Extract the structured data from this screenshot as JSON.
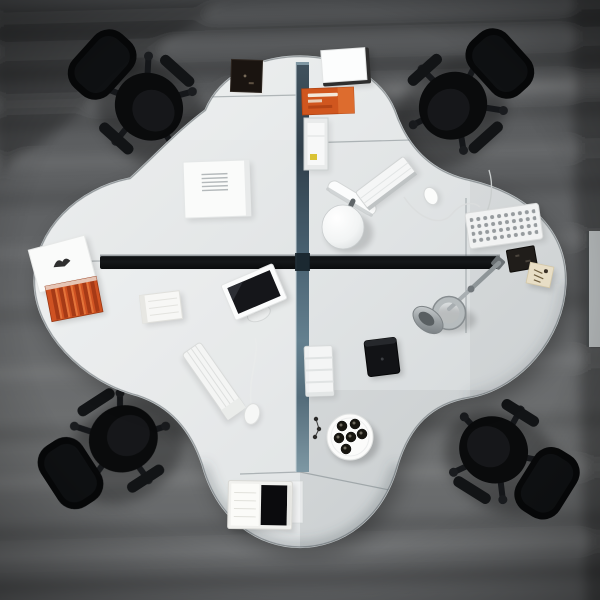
{
  "meta": {
    "description": "Overhead photograph of a four-person clover-shaped white office workstation with a blue-gray cross partition, four black task chairs and desk accessories, on a streaked gray floor."
  },
  "colors": {
    "floorBase": "#5b5d5f",
    "chairBlack": "#0a0b0c",
    "paperWhite": "#fafbfa",
    "deskTop": "#e2e5e6",
    "deskEdge": "#c5cacc",
    "partitionBlue": "#4a6272",
    "railDark": "#141719",
    "accentOrange": "#d0561e",
    "accentRed": "#cf5222",
    "screenDark": "#15161a",
    "metalGray": "#9aa0a3",
    "noteTan": "#e8dec6"
  },
  "labels": {
    "scene": "Top-down office workstation photograph",
    "floor": "Gray streaked office floor",
    "desk": "Clover-shaped four-seat desk island",
    "partition": "Vertical blue-gray privacy partition",
    "rail": "Horizontal black desk rail",
    "edgeFurniture": "Light furniture strip at right image edge",
    "chairNW": "Black office chair, top left",
    "chairNE": "Black office chair, top right",
    "chairSW": "Black office chair, bottom left",
    "chairSE": "Black office chair, bottom right",
    "bookDarkTL": "Dark book on top-left desk",
    "documentTL": "White document with printed lines",
    "cardTL": "White card with logo mark",
    "folderTL": "Red striped folder",
    "bookWhiteBL": "Small white book",
    "monitorBL": "Flat monitor lying on desk",
    "keyboardBL": "White keyboard, bottom-left desk",
    "mouseBL": "White mouse with cable",
    "binderBC": "Open binder with dark cover",
    "lampBR": "Metal articulated desk lamp",
    "tabletBR": "Dark tablet notebook",
    "trayBR": "White paper tray stack",
    "plateBR": "Round tray with espresso cups",
    "keysBR": "Small dark items",
    "whiteBoxTR": "White box with dark rim",
    "orangeLabelTR": "Orange label box",
    "docHolderTR": "White document holder",
    "lampWhiteTR": "White desk lamp",
    "keyboardTR": "White keyboard, top-right desk",
    "mouseTR": "Small white mouse",
    "dottedKeyboardTR": "White keyboard with dotted keys",
    "bookDarkTR": "Dark notebook",
    "noteTR": "Tan sticky note with writing"
  }
}
